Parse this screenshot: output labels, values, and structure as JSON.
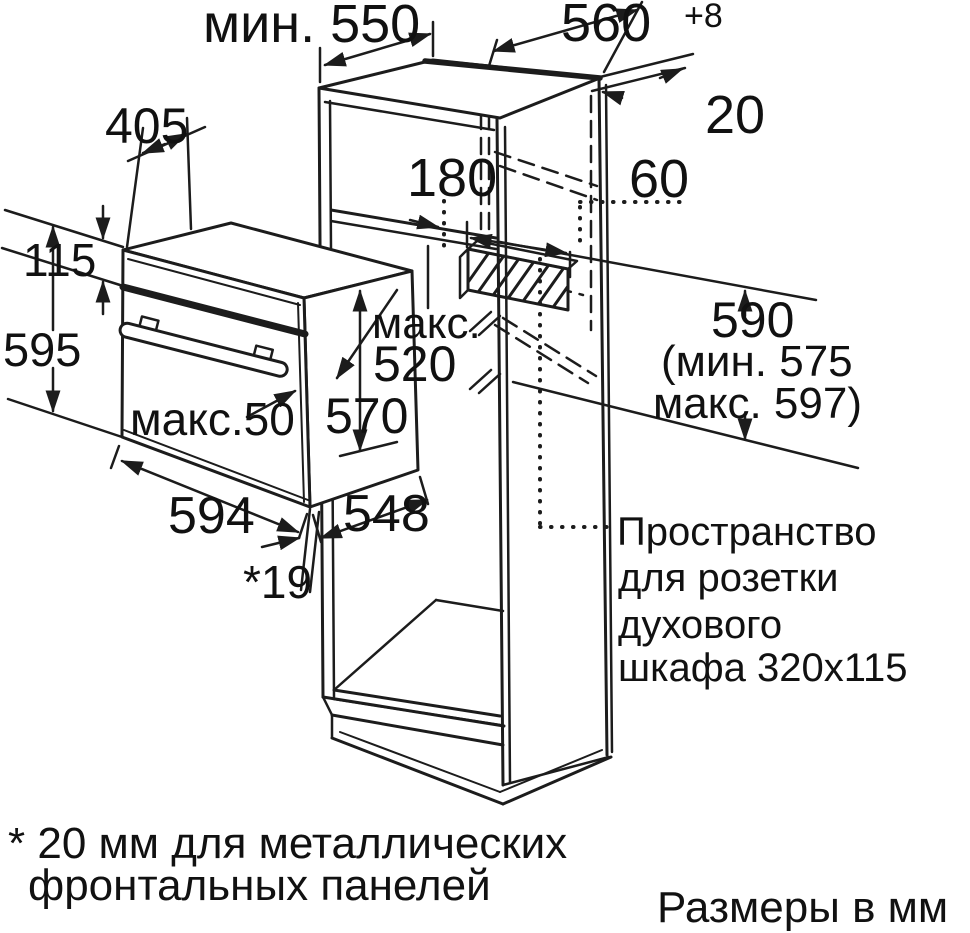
{
  "page": {
    "background": "#ffffff",
    "line_color": "#1c1c1c"
  },
  "labels": {
    "niche_depth_min": "мин. 550",
    "niche_width": "560",
    "niche_width_tol": "+8",
    "rear_panel_gap": "20",
    "pullout_depth": "405",
    "top_clearance": "180",
    "vent_offset": "60",
    "fascia_height": "115",
    "front_height": "595",
    "max_word": "макс.",
    "max_casing_depth": "520",
    "casing_height": "570",
    "door_protrusion": "макс.50",
    "oven_width": "594",
    "casing_depth": "548",
    "front_gap": "*19",
    "niche_height": "590",
    "niche_height_min": "(мин. 575",
    "niche_height_max": "макс. 597)",
    "socket_note_line1": "Пространство",
    "socket_note_line2": "для розетки",
    "socket_note_line3": "духового",
    "socket_note_line4": "шкафа 320x115",
    "footnote_line1": "* 20 мм для металлических",
    "footnote_line2": "фронтальных панелей",
    "units_note": "Размеры в мм"
  }
}
